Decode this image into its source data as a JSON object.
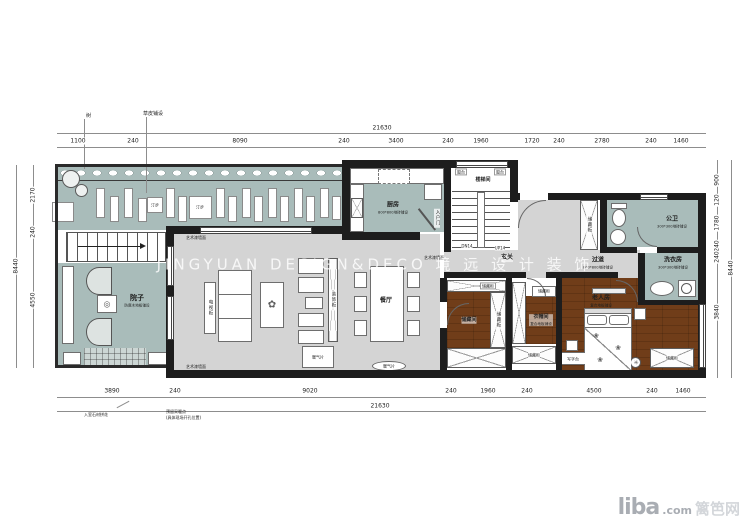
{
  "watermark": "JINGYUAN DESIGN&DECO 境 远 设 计 装 饰",
  "logo": {
    "name": "liba",
    "tld": ".com",
    "cn": "篱笆网"
  },
  "rooms": {
    "walkway": {
      "label_a": "汀步",
      "label_b": "汀步"
    },
    "courtyard": {
      "name": "院子",
      "note": "防腐木地板铺设"
    },
    "kitchen": {
      "name": "厨房",
      "note": "800*800地砖铺设",
      "door": "入户门"
    },
    "stairwell": {
      "name": "楼梯间",
      "tag_l": "窗台",
      "tag_r": "窗台",
      "down": "DN14",
      "up": "UP14"
    },
    "foyer": {
      "name": "玄关"
    },
    "dining": {
      "name": "餐厅"
    },
    "storage": {
      "name": "储藏间",
      "cab_top": "储藏柜",
      "cab_side": "储藏柜"
    },
    "cloakroom": {
      "name": "衣帽间",
      "note": "复合地板铺设",
      "cab_top": "储藏柜",
      "cab_bottom": "储藏柜"
    },
    "hallway": {
      "name": "过道",
      "note": "800*800地砖铺设"
    },
    "bathroom": {
      "name": "公卫",
      "note": "300*300地砖铺设",
      "cab": "储藏柜"
    },
    "laundry": {
      "name": "洗衣房",
      "note": "300*300地砖铺设"
    },
    "elder": {
      "name": "老人房",
      "note": "复合地板铺设",
      "desk": "写字台",
      "wardrobe": "储藏柜"
    },
    "living": {
      "tv": "电视柜",
      "deco": "装饰柜",
      "radiator": "暖气片",
      "wall_note": "艺术漆墙面"
    }
  },
  "annotations": {
    "tree": "树",
    "grass": "草皮铺设",
    "entry_stone": "入室石材拼花",
    "reserve1": "预留采暖点",
    "reserve2": "(具体现场开孔位置)"
  },
  "dims": {
    "top_overall": "21630",
    "top": [
      "1100",
      "240",
      "8090",
      "240",
      "3400",
      "240",
      "1960",
      "1720",
      "240",
      "2780",
      "240",
      "1460"
    ],
    "bottom_overall": "21630",
    "bottom": [
      "3890",
      "240",
      "9020",
      "240",
      "1960",
      "240",
      "4500",
      "240",
      "1460"
    ],
    "left": [
      "2170",
      "240",
      "4550"
    ],
    "left_overall": "8440",
    "right": [
      "900",
      "120",
      "1780",
      "240",
      "240",
      "3840"
    ],
    "right_overall": "8440"
  },
  "colors": {
    "teal": "#a9bcba",
    "floor_gray": "#d4d4d4",
    "wood": "#a97d50",
    "wall": "#1d1d1d"
  }
}
